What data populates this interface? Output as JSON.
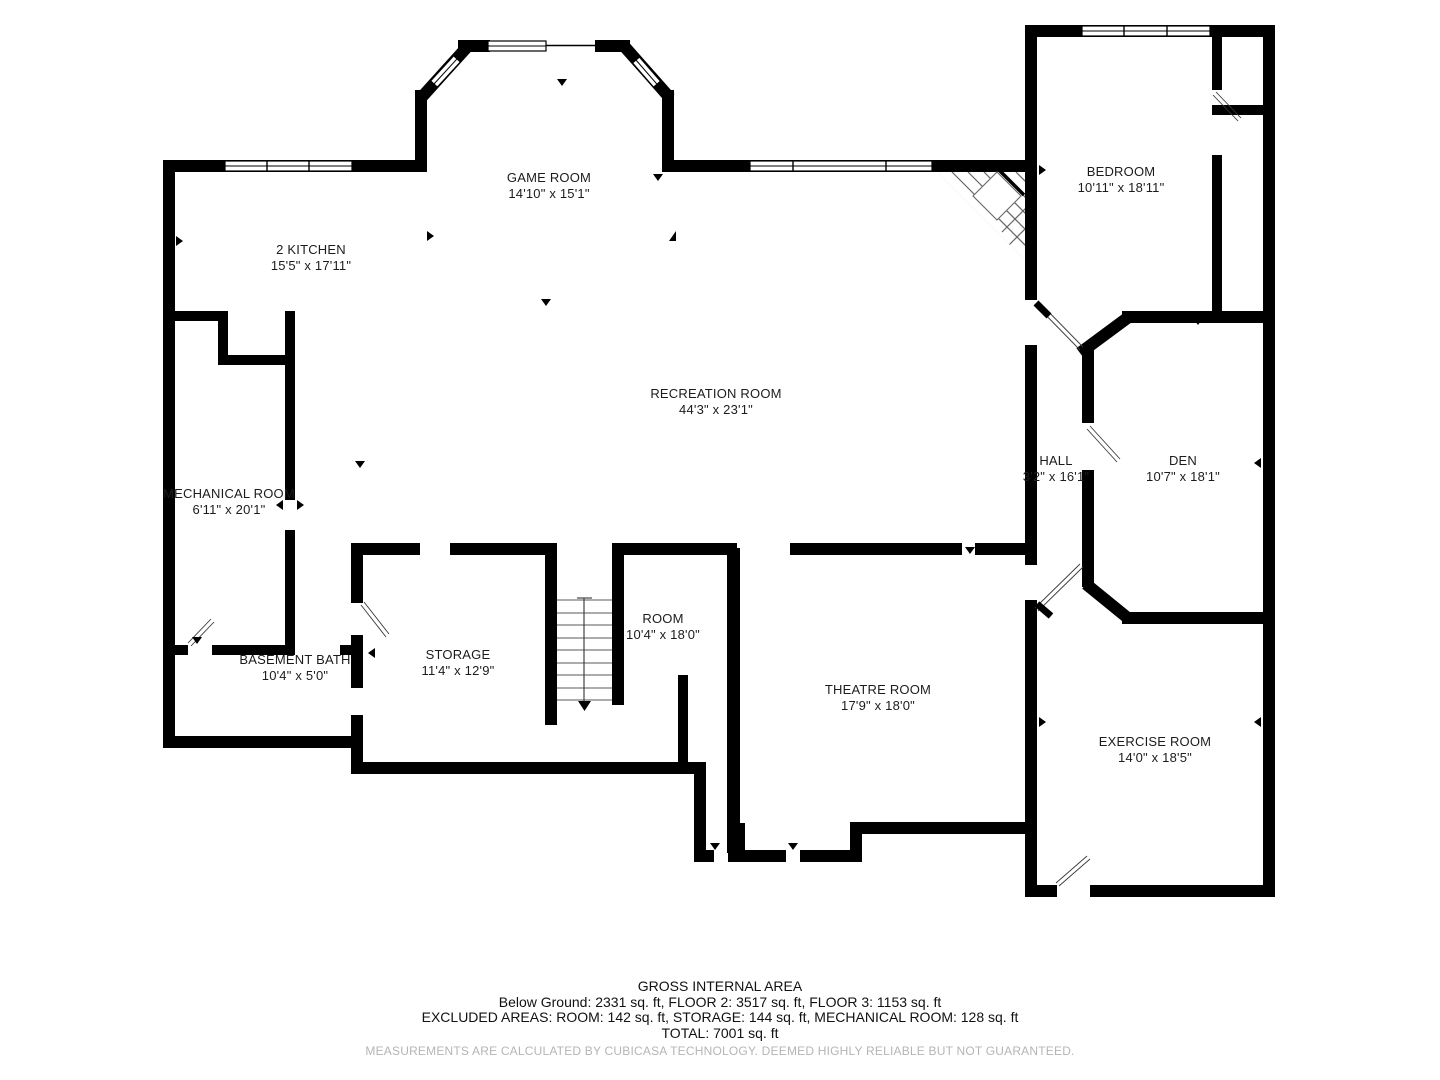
{
  "floorplan": {
    "rooms": [
      {
        "name": "GAME ROOM",
        "dims": "14'10\" x 15'1\""
      },
      {
        "name": "2 KITCHEN",
        "dims": "15'5\" x 17'11\""
      },
      {
        "name": "BEDROOM",
        "dims": "10'11\" x 18'11\""
      },
      {
        "name": "RECREATION ROOM",
        "dims": "44'3\" x 23'1\""
      },
      {
        "name": "MECHANICAL ROOM",
        "dims": "6'11\" x 20'1\""
      },
      {
        "name": "HALL",
        "dims": "3'2\" x 16'1\""
      },
      {
        "name": "DEN",
        "dims": "10'7\" x 18'1\""
      },
      {
        "name": "BASEMENT BATH",
        "dims": "10'4\" x 5'0\""
      },
      {
        "name": "STORAGE",
        "dims": "11'4\" x 12'9\""
      },
      {
        "name": "ROOM",
        "dims": "10'4\" x 18'0\""
      },
      {
        "name": "THEATRE ROOM",
        "dims": "17'9\" x 18'0\""
      },
      {
        "name": "EXERCISE ROOM",
        "dims": "14'0\" x 18'5\""
      }
    ],
    "footer": {
      "title": "GROSS INTERNAL AREA",
      "line1": "Below Ground: 2331 sq. ft, FLOOR 2: 3517 sq. ft, FLOOR 3: 1153 sq. ft",
      "line2": "EXCLUDED AREAS: ROOM: 142 sq. ft, STORAGE: 144 sq. ft, MECHANICAL ROOM: 128 sq. ft",
      "line3": "TOTAL: 7001 sq. ft",
      "disclaimer": "MEASUREMENTS ARE CALCULATED BY CUBICASA TECHNOLOGY. DEEMED HIGHLY RELIABLE BUT NOT GUARANTEED."
    },
    "colors": {
      "wall": "#000000",
      "text": "#1c1c1c",
      "disclaimer": "#b5b5b5"
    }
  }
}
